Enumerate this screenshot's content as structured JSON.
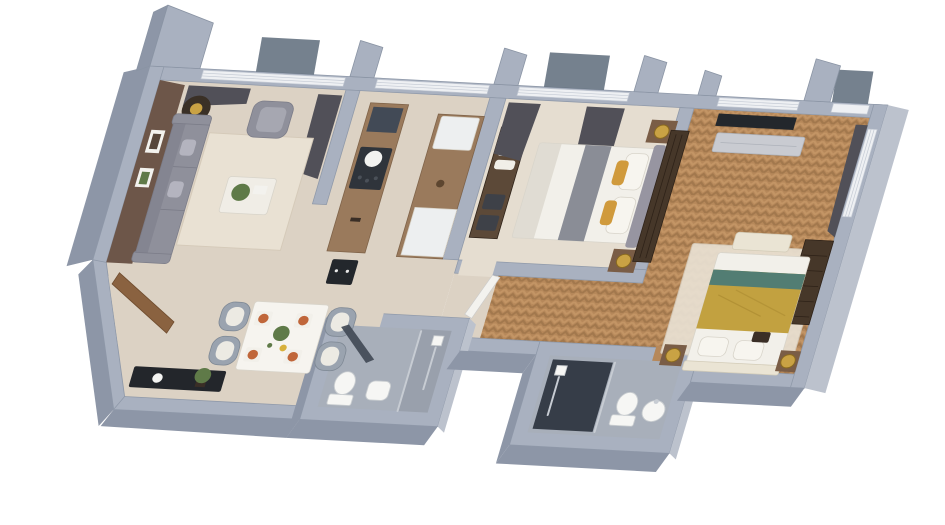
{
  "scene": {
    "kind": "3d-apartment-floor-plan-render",
    "background": "#ffffff"
  },
  "c": {
    "wallTop": "#a9b1c0",
    "wallSide": "#8d96a7",
    "wallSideLight": "#bcc2cd",
    "windowBand": "#eef0f3",
    "windowLine": "#c4cad4",
    "glass": "#5d6b7a",
    "floorBase": "#dcd2c4",
    "floorBedroom": "#e5ddd0",
    "floorBath": "#a8afba",
    "bathShower": "#99a0ac",
    "showerDark": "#363d48",
    "woodBase": "#b6885a",
    "woodDark": "#9e744a",
    "woodLight": "#c99a6a",
    "accentWall": "#6d5649",
    "frameWhite": "#f3f2ee",
    "frameInner": "#57463a",
    "sofaGray": "#8f909b",
    "sofaDark": "#7b7c88",
    "sofaLight": "#a6a7b1",
    "pillowGray": "#b4b4bf",
    "rug": "#e9e1d3",
    "rugEdge": "#d5cab9",
    "tableDark": "#3a3026",
    "coffeeTable": "#f0ede6",
    "tableWhite": "#f6f4ef",
    "chairGray": "#9aa3af",
    "chairSeat": "#eceae3",
    "plateTerracotta": "#c0663a",
    "accentYellow": "#d8b13c",
    "plantGreen": "#5f7a48",
    "consoleBlack": "#23262b",
    "bowlWhite": "#f4f4f2",
    "counterWood": "#9a7a5c",
    "cooktopDark": "#2f343b",
    "potWhite": "#f2f2f0",
    "applianceWhite": "#edeff0",
    "shelfWood": "#5c4938",
    "towelWhite": "#f1efe8",
    "basketDark": "#3e4148",
    "doorWood": "#8a6240",
    "bedWhite": "#f2f0ea",
    "sheetShadow": "#dbd7cd",
    "runnerGray": "#8a8d96",
    "headboardGray": "#9795a1",
    "pillowWhite": "#f7f5ef",
    "pillowMustard": "#d09a3c",
    "nightstandWood": "#7a5d46",
    "lampGold": "#c9a244",
    "wardrobeDark": "#463729",
    "tvBlack": "#23272c",
    "mediaGray": "#c9cbd1",
    "blanketMustard": "#c2a140",
    "stripeTeal": "#527d73",
    "benchCream": "#eae4d4",
    "accentPillowDark": "#3a2e26",
    "fixtureWhite": "#f6f6f4",
    "chrome": "#c7ccd3",
    "glassPanel": "#424a56",
    "curtainDark": "#515058"
  },
  "semantics": {
    "rooms": [
      "living-room",
      "entry-hall",
      "dining-area",
      "kitchen",
      "bathroom-1",
      "bedroom-2",
      "hallway",
      "bathroom-2",
      "master-bedroom"
    ]
  }
}
